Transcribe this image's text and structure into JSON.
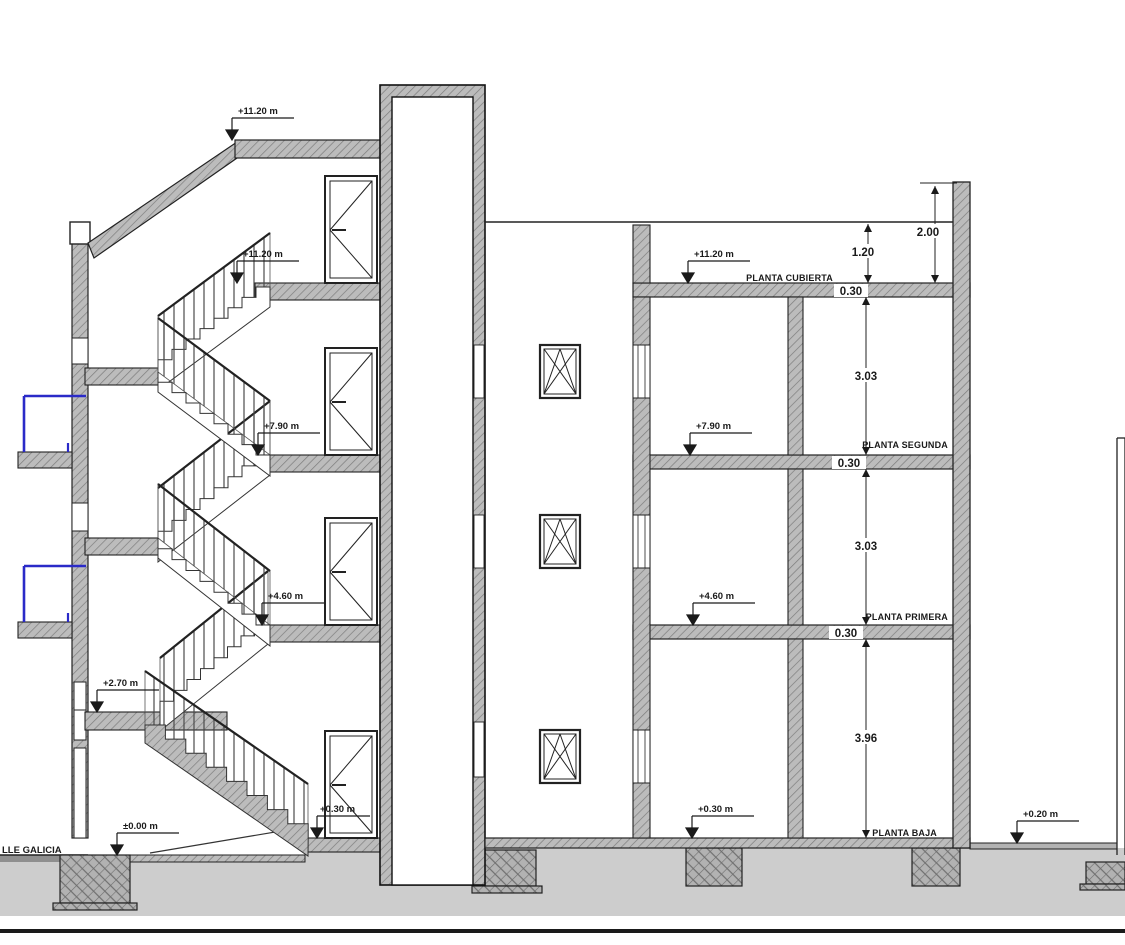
{
  "title": "Seccion - building section drawing",
  "street": {
    "label": "LLE GALICIA"
  },
  "floors": {
    "cubierta": "PLANTA CUBIERTA",
    "segunda": "PLANTA SEGUNDA",
    "primera": "PLANTA PRIMERA",
    "baja": "PLANTA BAJA"
  },
  "levels": {
    "stair_roof_top": "+11.20 m",
    "stair_cubierta": "+11.20 m",
    "stair_segunda": "+7.90 m",
    "stair_primera": "+4.60 m",
    "stair_media": "+2.70 m",
    "calle": "±0.00 m",
    "stair_baja": "+0.30 m",
    "right_cubierta": "+11.20 m",
    "right_segunda": "+7.90 m",
    "right_primera": "+4.60 m",
    "right_baja": "+0.30 m",
    "patio": "+0.20 m"
  },
  "dims": {
    "parapet": "2.00",
    "antepecho": "1.20",
    "forjado_cubierta": "0.30",
    "altura_segunda": "3.03",
    "forjado_segunda": "0.30",
    "altura_primera": "3.03",
    "forjado_primera": "0.30",
    "altura_baja": "3.96"
  },
  "colors": {
    "railing_blue": "#2a2ac8",
    "wall_gray": "#bcbcbc",
    "ground_gray": "#cdcdcd"
  }
}
